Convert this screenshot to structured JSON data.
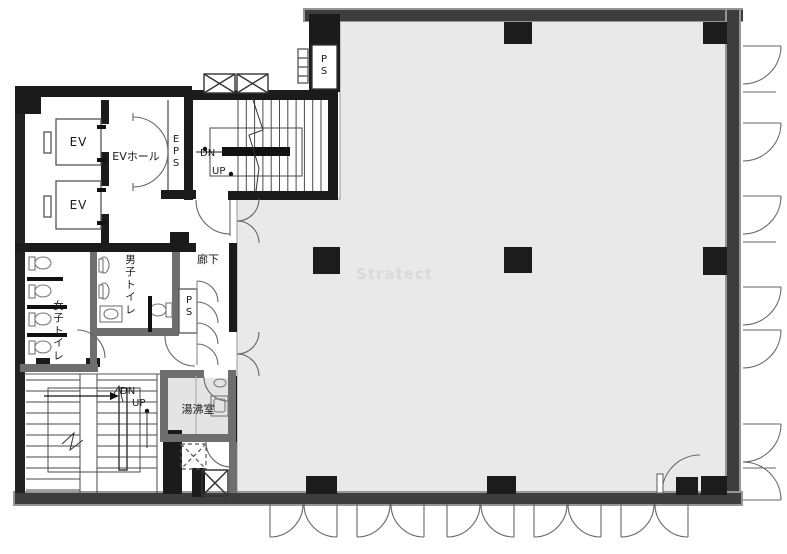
{
  "watermark": "Stratect",
  "rooms": {
    "ev_top": "EV",
    "ev_bottom": "EV",
    "ev_hall": "EVホール",
    "eps": "EPS",
    "ps_top": "PS",
    "ps_mid": "PS",
    "corridor": "廊下",
    "mens_toilet": "男子トイレ",
    "womens_toilet": "女子トイレ",
    "kitchenette": "湯沸室"
  },
  "stairs_upper": {
    "down": "DN",
    "up": "UP"
  },
  "stairs_lower": {
    "down": "DN",
    "up": "UP"
  },
  "colors": {
    "floor": "#e9e9e9",
    "kitchenette_floor": "#e4e4e4",
    "wall_dark": "#3d3d3d",
    "wall_black": "#1b1b1b",
    "wall_light_edge": "#969696",
    "partition_gray": "#6e6e6e",
    "thin_line": "#555555",
    "door_line": "#666666",
    "watermark": "#d9d9d9"
  }
}
